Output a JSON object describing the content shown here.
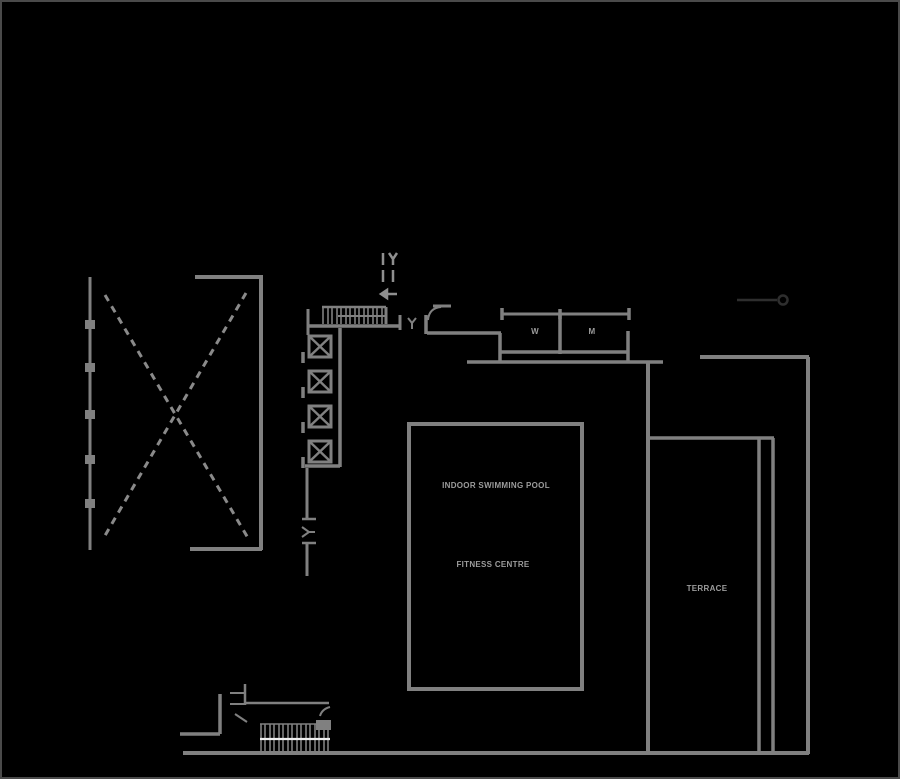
{
  "drawing": {
    "type": "architectural-floor-plan",
    "background": "#000000",
    "border_color": "#4a4a4a",
    "line_color": "#808080",
    "text_color": "#9c9c9c",
    "leader_color": "#2e2e2e",
    "stair_centerline_color": "#eeeeee"
  },
  "labels": {
    "pool": "INDOOR SWIMMING POOL",
    "fitness": "FITNESS CENTRE",
    "terrace": "TERRACE",
    "room_w": "W",
    "room_m": "M"
  }
}
